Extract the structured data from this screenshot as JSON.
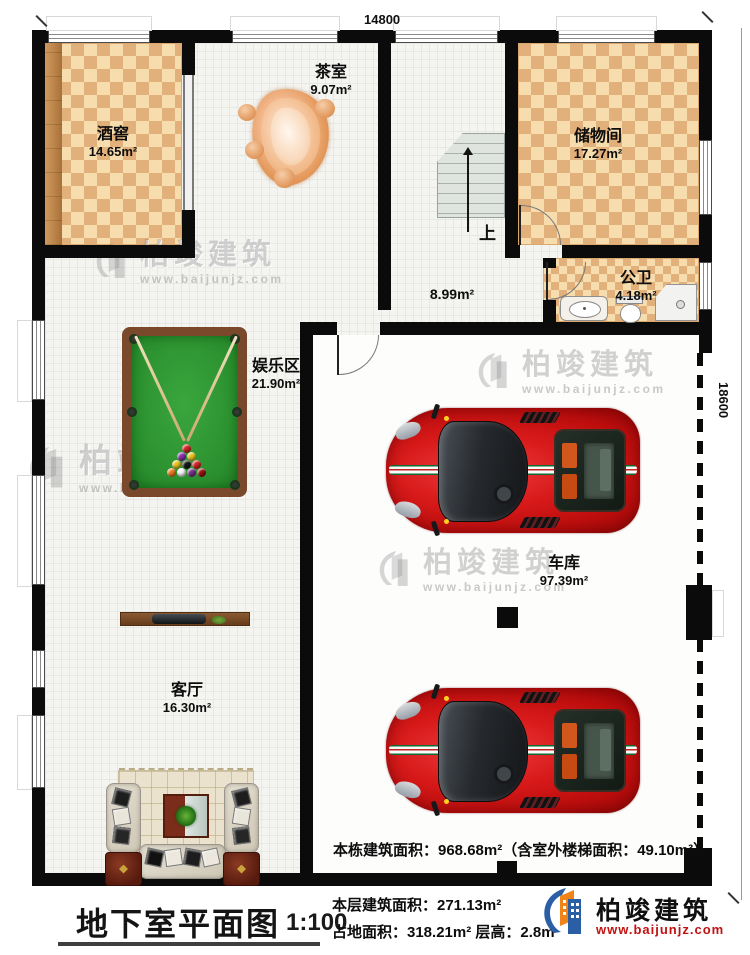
{
  "plan": {
    "dim_top": "14800",
    "dim_right": "18600",
    "rooms": {
      "wine": {
        "name": "酒窖",
        "area": "14.65m²"
      },
      "tea": {
        "name": "茶室",
        "area": "9.07m²"
      },
      "storage": {
        "name": "储物间",
        "area": "17.27m²"
      },
      "bath": {
        "name": "公卫",
        "area": "4.18m²"
      },
      "hall": {
        "area": "8.99m²"
      },
      "play": {
        "name": "娱乐区",
        "area": "21.90m²"
      },
      "garage": {
        "name": "车库",
        "area": "97.39m²"
      },
      "living": {
        "name": "客厅",
        "area": "16.30m²"
      }
    },
    "stairs_up": "上",
    "note": "本栋建筑面积：968.68m²（含室外楼梯面积：49.10m²）"
  },
  "titlebar": {
    "title": "地下室平面图",
    "scale": "1:100",
    "stat1": "本层建筑面积：271.13m²",
    "stat2": "占地面积：318.21m²  层高：2.8m"
  },
  "brand": {
    "name": "柏竣建筑",
    "site": "www.baijunjz.com"
  },
  "watermark": {
    "name": "柏竣建筑",
    "site": "www.baijunjz.com"
  },
  "colors": {
    "wall": "#0b0b0b",
    "checker_light": "#f7ddae",
    "checker_dark": "#e2b07a",
    "table_green": "#2f9932",
    "table_wood": "#7a482a",
    "car_red": "#d81a1a",
    "brand_blue": "#2a5fa5",
    "brand_orange": "#ef8418",
    "brand_red": "#c11111"
  }
}
